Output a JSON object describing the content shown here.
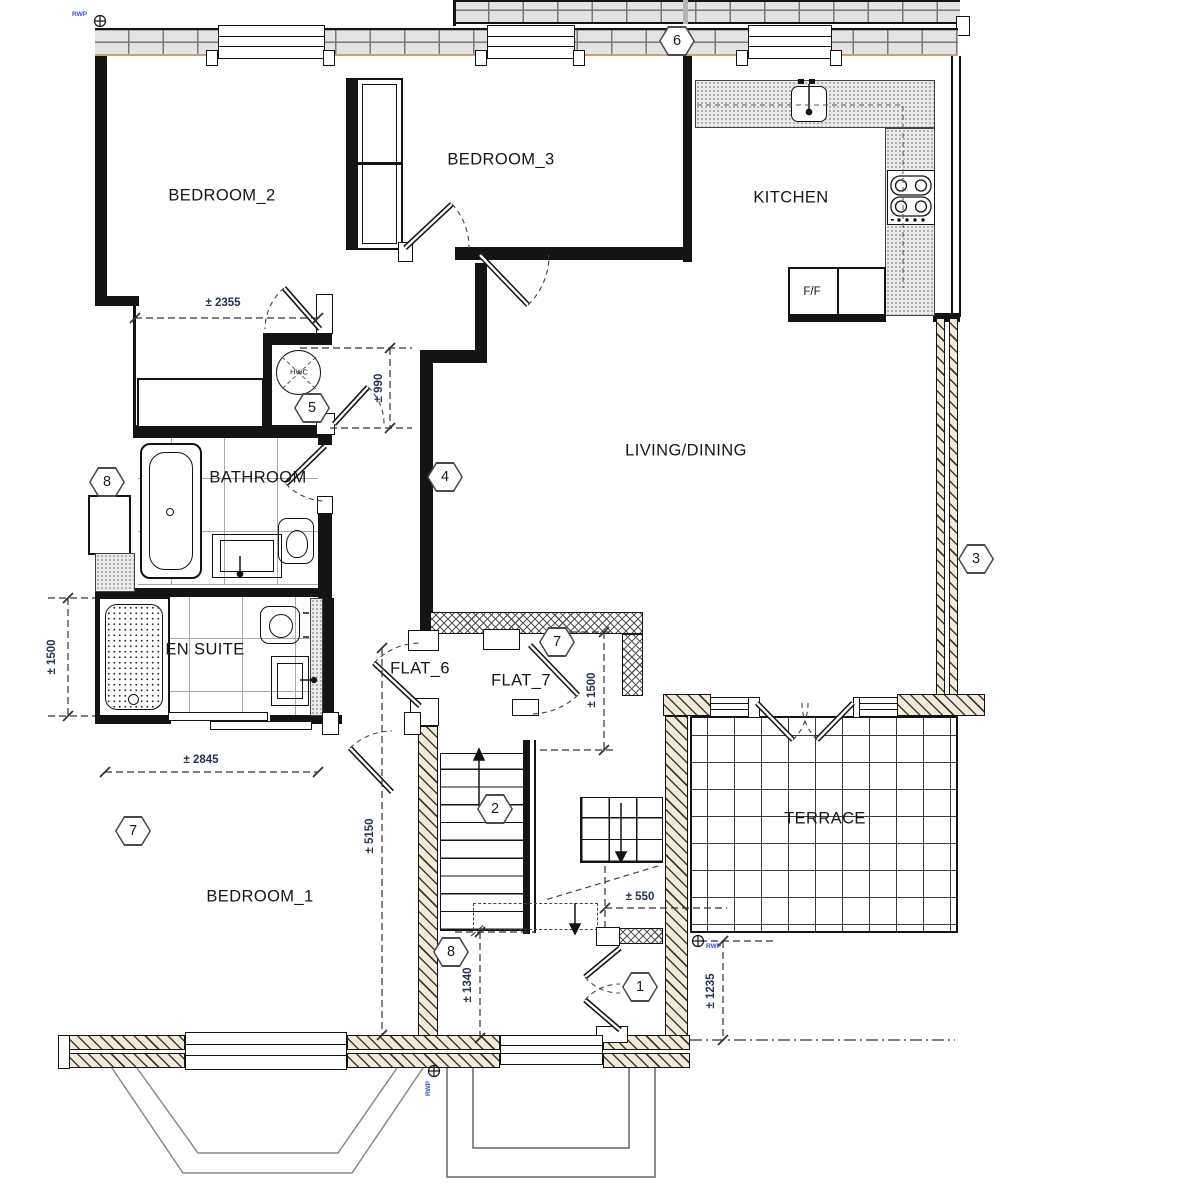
{
  "rooms": {
    "bedroom2": "BEDROOM_2",
    "bedroom3": "BEDROOM_3",
    "kitchen": "KITCHEN",
    "living": "LIVING/DINING",
    "bathroom": "BATHROOM",
    "ensuite": "EN SUITE",
    "flat6": "FLAT_6",
    "flat7": "FLAT_7",
    "bedroom1": "BEDROOM_1",
    "terrace": "TERRACE"
  },
  "appliances": {
    "fridge_freezer": "F/F",
    "hot_water_cylinder": "HWC"
  },
  "dimensions": {
    "bedroom2_width": "± 2355",
    "hwc_door_width": "± 990",
    "ensuite_depth": "± 1500",
    "bedroom1_width": "± 2845",
    "flat7_clearance": "± 1500",
    "bedroom1_length": "± 5150",
    "lobby_width": "± 1340",
    "stair_offset": "± 550",
    "entrance_depth": "± 1235"
  },
  "markers": {
    "roof_wall": "6",
    "hwc_cupboard": "5",
    "bathroom_west": "8",
    "hall_wall": "4",
    "east_wall": "3",
    "flat7_door": "7",
    "stair_flight": "2",
    "bedroom1_west": "7",
    "lobby_floor": "8",
    "entrance_door": "1"
  },
  "annotations": {
    "rainwater_pipe": "RWP"
  },
  "colors": {
    "wall_hatch": "#f4ead8",
    "brick_fill": "#e3e3e3",
    "counter_fill": "#eaeaea",
    "dimension_text": "#26324f",
    "rwp_text": "#3355cc",
    "line": "#141414"
  }
}
